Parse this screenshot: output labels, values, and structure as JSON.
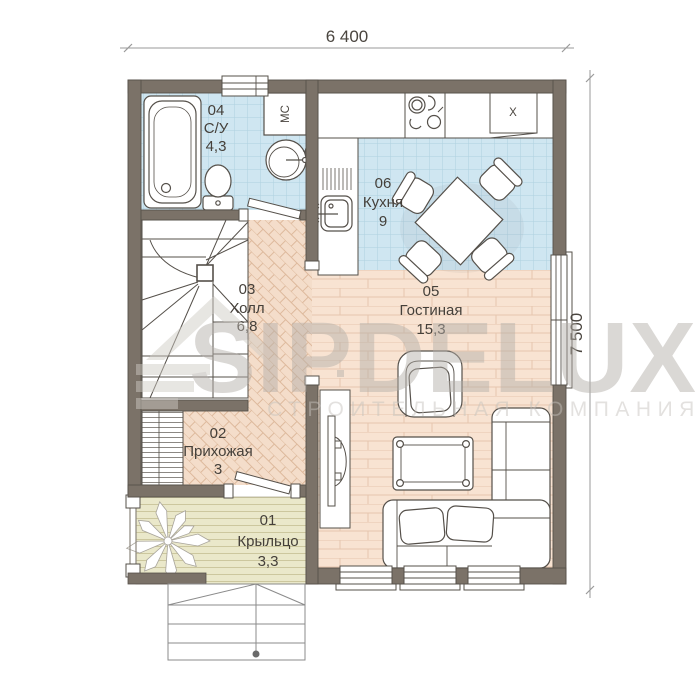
{
  "dimensions": {
    "width": "6 400",
    "height": "7 500"
  },
  "rooms": [
    {
      "id": "01",
      "name": "Крыльцо",
      "area": "3,3"
    },
    {
      "id": "02",
      "name": "Прихожая",
      "area": "3"
    },
    {
      "id": "03",
      "name": "Холл",
      "area": "6,8"
    },
    {
      "id": "04",
      "name": "С/У",
      "area": "4,3"
    },
    {
      "id": "05",
      "name": "Гостиная",
      "area": "15,3"
    },
    {
      "id": "06",
      "name": "Кухня",
      "area": "9"
    }
  ],
  "labels": {
    "washer": "МС",
    "fridge": "Х"
  },
  "watermark": {
    "brand": "SIPDELUX",
    "tagline": "СТРОИТЕЛЬНАЯ КОМПАНИЯ"
  },
  "palette": {
    "wall": "#7b7268",
    "outline": "#4f4a43",
    "tile": "#cfe6f1",
    "tile_line": "#aed0e0",
    "hall_floor": "#f4ddca",
    "hall_line": "#ddb99c",
    "living_floor": "#f8e3d2",
    "living_line": "#e6c6ae",
    "porch_floor": "#eae8ca",
    "porch_line": "#ccc79e",
    "watermark_gray": "#b4afa9"
  }
}
